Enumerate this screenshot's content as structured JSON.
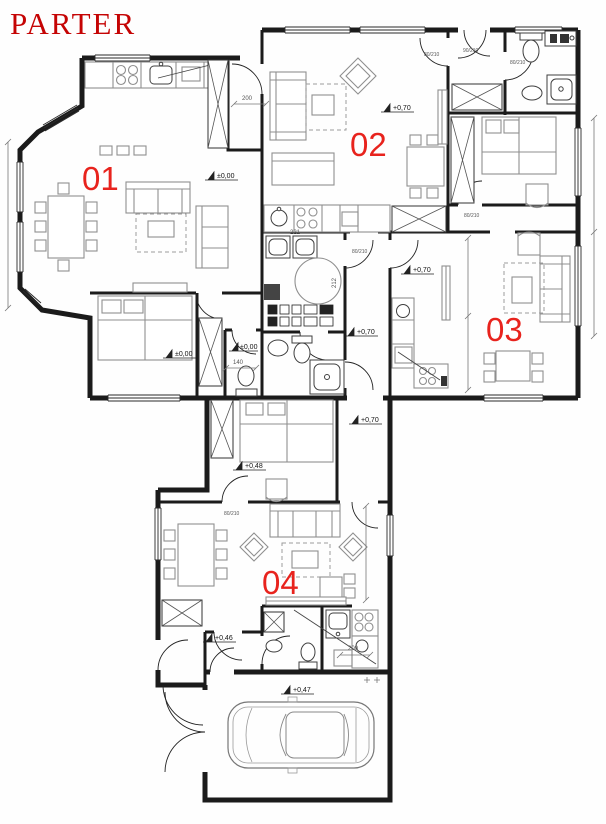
{
  "title": "PARTER",
  "colors": {
    "title_red": "#c50404",
    "unit_label_red": "#e8231d",
    "wall_black": "#1b1b1b",
    "furniture_gray": "#8f8f8f"
  },
  "units": {
    "u01": "01",
    "u02": "02",
    "u03": "03",
    "u04": "04"
  },
  "elevation_markers": {
    "living01": "±0,00",
    "bedroom01": "±0,00",
    "wc01": "±0,00",
    "living02": "+0,70",
    "living03": "+0,70",
    "hallway": "+0,70",
    "corridor": "+0,70",
    "bedroom_mid": "+0,48",
    "entry04": "+0,46",
    "garage": "+0,47"
  },
  "dimension_labels": {
    "kitchen01_width": "200",
    "core_width": "221",
    "core_height": "212",
    "wc01_width": "140",
    "kitchen04_width": "200"
  },
  "door_size_labels": {
    "standard": "80/210",
    "entry": "90/210"
  }
}
